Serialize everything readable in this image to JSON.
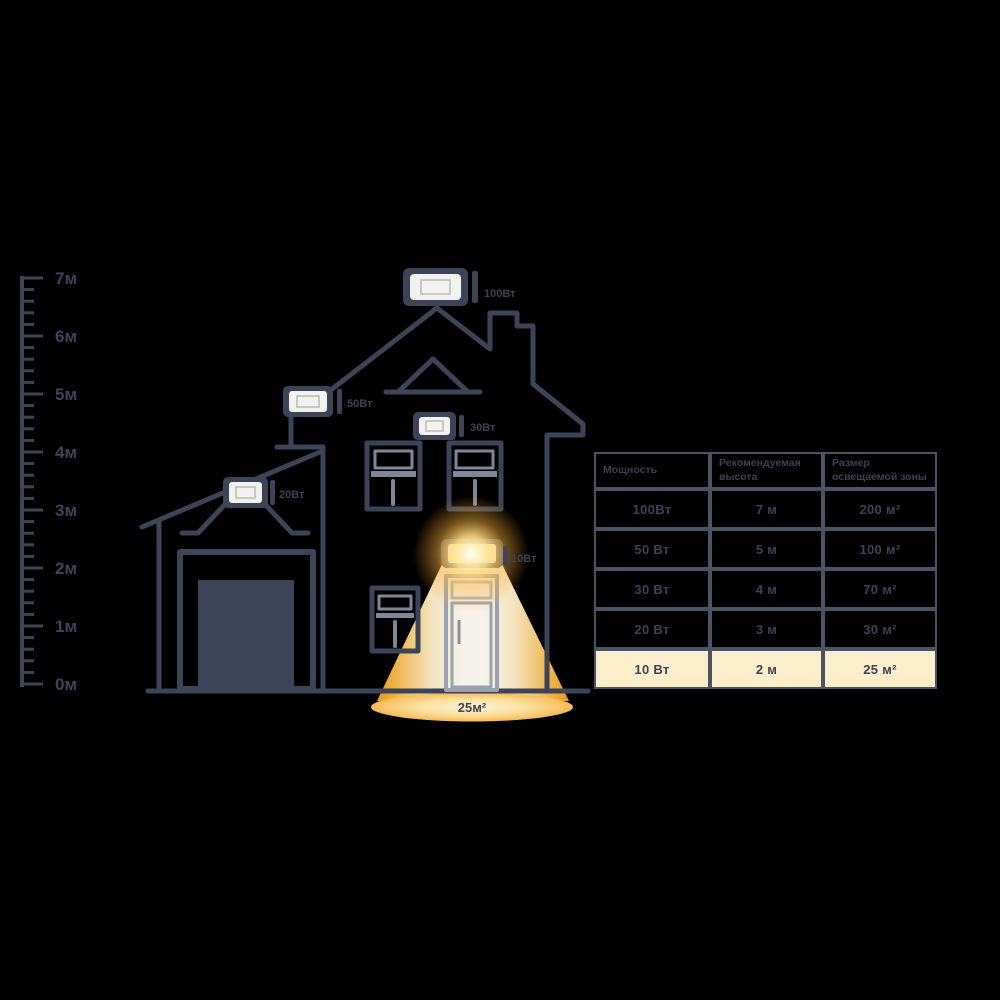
{
  "colors": {
    "outline": "#3d4457",
    "beam_orange": "#f5a623",
    "highlight_bg": "#fbeecb",
    "label_text": "#3a4254",
    "floodlight_face": "#f2f2ef"
  },
  "ruler": {
    "labels": [
      "7м",
      "6м",
      "5м",
      "4м",
      "3м",
      "2м",
      "1м",
      "0м"
    ]
  },
  "floodlights": [
    {
      "label": "100Вт"
    },
    {
      "label": "50Вт"
    },
    {
      "label": "30Вт"
    },
    {
      "label": "20Вт"
    },
    {
      "label": "10Вт"
    }
  ],
  "beam": {
    "area_label": "25м²"
  },
  "table": {
    "headers": [
      "Мощность",
      "Рекомендуемая высота",
      "Размер освещаемой зоны"
    ],
    "rows": [
      [
        "100Вт",
        "7 м",
        "200 м²"
      ],
      [
        "50 Вт",
        "5 м",
        "100 м²"
      ],
      [
        "30 Вт",
        "4 м",
        "70 м²"
      ],
      [
        "20 Вт",
        "3 м",
        "30 м²"
      ],
      [
        "10 Вт",
        "2 м",
        "25 м²"
      ]
    ],
    "highlighted_row_index": 4
  }
}
